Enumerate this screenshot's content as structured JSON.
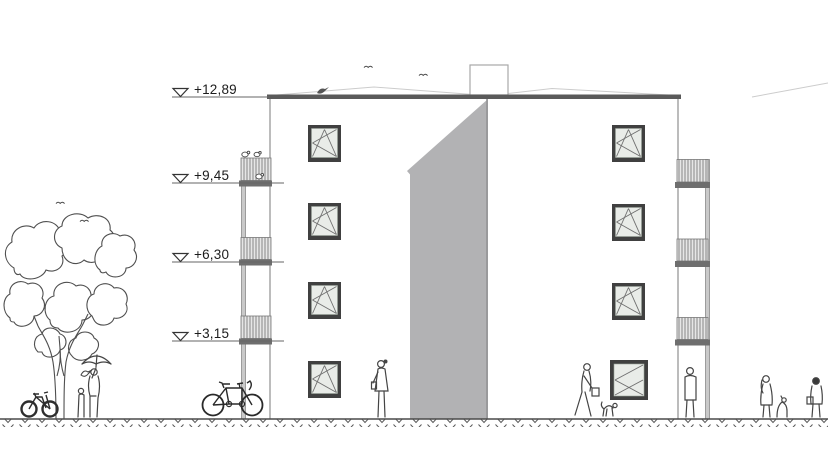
{
  "drawing": {
    "type": "architectural-elevation",
    "floors": 4,
    "balcony_columns": 2
  },
  "markers": {
    "items": [
      {
        "label": "+12,89"
      },
      {
        "label": "+9,45"
      },
      {
        "label": "+6,30"
      },
      {
        "label": "+3,15"
      }
    ]
  },
  "colors": {
    "shaft_gray": "#b2b2b4",
    "shaft_edge": "#949496",
    "roof_bar": "#5a5a5a",
    "slab": "#6e6e6e",
    "window_frame": "#404040",
    "glass": "#e9ece8",
    "line": "#4a4a4a",
    "faint_roof": "#cccccc",
    "post": "#c9c9c9"
  }
}
